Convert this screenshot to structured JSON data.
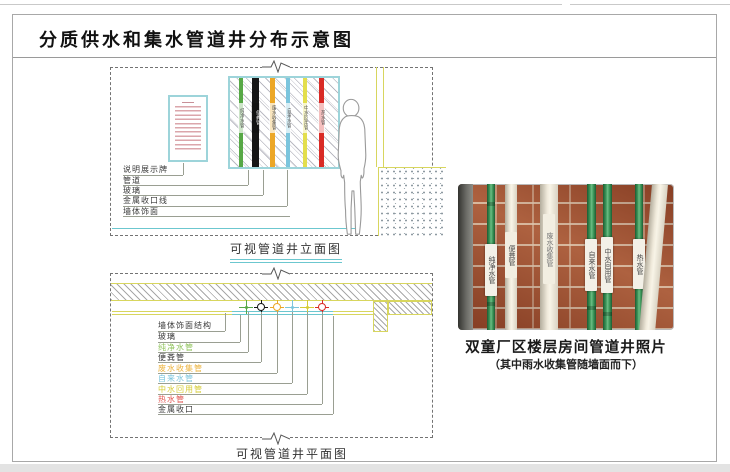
{
  "title": "分质供水和集水管道井分布示意图",
  "colors": {
    "accent_cyan": "#6cc7cf",
    "accent_yellow": "#d8d65e",
    "brick": "#9c4a2b"
  },
  "elevation": {
    "caption": "可视管道井立面图",
    "labels": [
      "说明展示牌",
      "管道",
      "玻璃",
      "金属收口线",
      "墙体饰面"
    ],
    "pipes": [
      {
        "name": "纯净水管",
        "color": "#57a846"
      },
      {
        "name": "便粪管",
        "color": "#161616"
      },
      {
        "name": "废水收集管",
        "color": "#eca727"
      },
      {
        "name": "自来水管",
        "color": "#7cc5dd"
      },
      {
        "name": "中水回用管",
        "color": "#e3de4d"
      },
      {
        "name": "热水管",
        "color": "#d92b26"
      }
    ]
  },
  "plan": {
    "caption": "可视管道井平面图",
    "labels": [
      {
        "text": "墙体饰面结构",
        "color": "#3a3a3a"
      },
      {
        "text": "玻璃",
        "color": "#3a3a3a"
      },
      {
        "text": "纯净水管",
        "color": "#8fc35a"
      },
      {
        "text": "便粪管",
        "color": "#3a3a3a"
      },
      {
        "text": "废水收集管",
        "color": "#ecb33c"
      },
      {
        "text": "自来水管",
        "color": "#7cc5dd"
      },
      {
        "text": "中水回用管",
        "color": "#d6cc35"
      },
      {
        "text": "热水管",
        "color": "#e25550"
      },
      {
        "text": "金属收口",
        "color": "#3a3a3a"
      }
    ],
    "symbols": [
      {
        "color": "#57a846",
        "type": "cross"
      },
      {
        "color": "#161616",
        "type": "circle"
      },
      {
        "color": "#eca727",
        "type": "circle"
      },
      {
        "color": "#7cc5dd",
        "type": "cross"
      },
      {
        "color": "#d6cc35",
        "type": "cross"
      },
      {
        "color": "#d92b26",
        "type": "circle"
      }
    ]
  },
  "photo": {
    "caption": "双童厂区楼层房间管道井照片",
    "subcaption": "（其中雨水收集管随墙面而下）",
    "pipes": [
      {
        "label": "纯净水管",
        "color": "#3f9a5c"
      },
      {
        "label": "便粪管",
        "color": "#efe9da"
      },
      {
        "label": "废水收集管",
        "color": "#efe9da"
      },
      {
        "label": "自来水管",
        "color": "#3f9a5c"
      },
      {
        "label": "中水回用管",
        "color": "#3f9a5c"
      },
      {
        "label": "热水管",
        "color": "#3f9a5c"
      }
    ]
  }
}
